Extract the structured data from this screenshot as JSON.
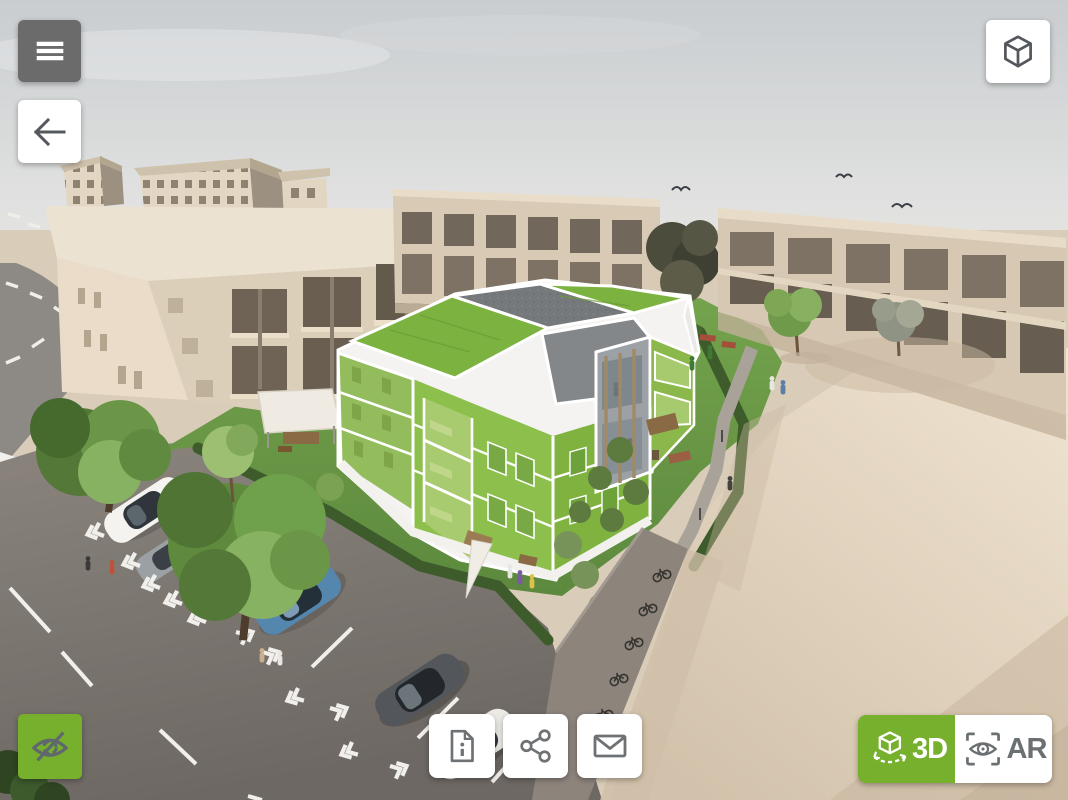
{
  "meta": {
    "width": 1068,
    "height": 800,
    "app": "3d-building-tour-viewer"
  },
  "colors": {
    "accent_green": "#76b02c",
    "toolbar_dark_gray": "#6b6b6b",
    "icon_gray": "#666b6e",
    "button_white": "#ffffff",
    "highlight_building_green": "#8cc34c"
  },
  "controls": {
    "menu_button": {
      "icon": "hamburger-menu-icon"
    },
    "back_button": {
      "icon": "arrow-left-icon"
    },
    "model_view_button": {
      "icon": "cube-icon"
    },
    "hide_overlay_button": {
      "icon": "eye-slash-icon"
    },
    "info_button": {
      "icon": "document-info-icon"
    },
    "share_button": {
      "icon": "share-nodes-icon"
    },
    "contact_button": {
      "icon": "envelope-icon"
    },
    "view_switcher": {
      "mode_3d": {
        "label": "3D",
        "icon": "cube-rotate-icon",
        "active": true
      },
      "mode_ar": {
        "label": "AR",
        "icon": "ar-eye-icon",
        "active": false
      }
    }
  },
  "scene": {
    "description": "Aerial 3D architectural rendering: apartment building highlighted in translucent green with white outlines, beige neighbouring blocks, gardens, parking lot with cars and a beige plaza.",
    "highlighted_object": "apartment-building"
  }
}
